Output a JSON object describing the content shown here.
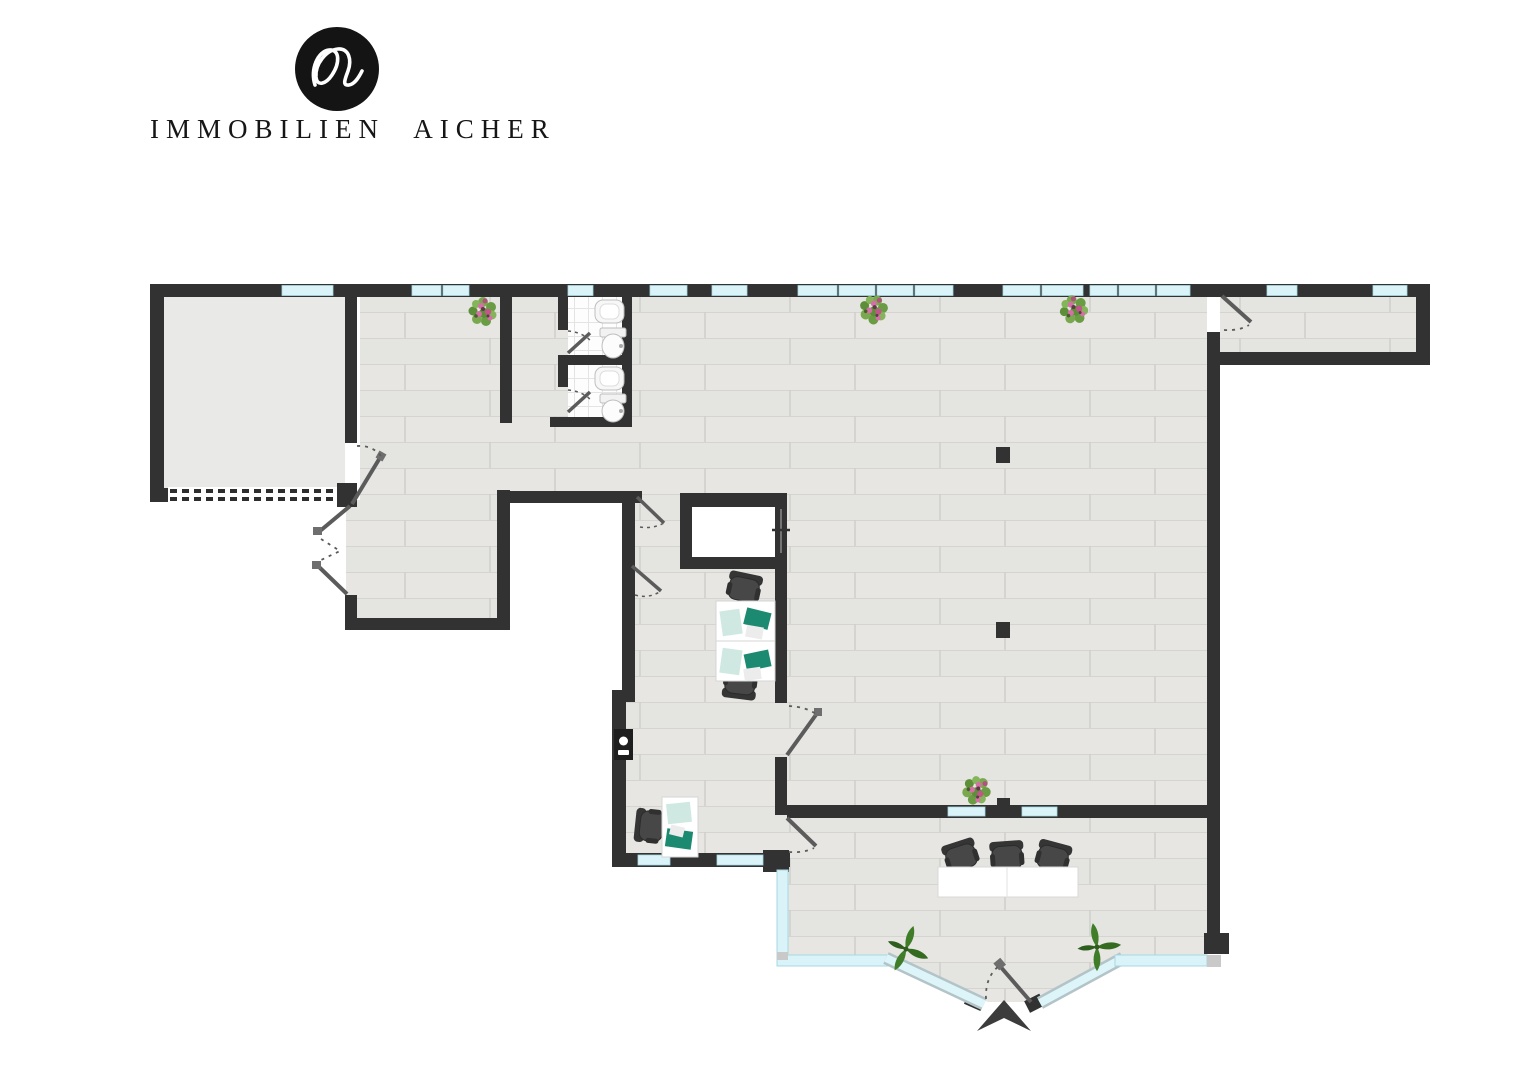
{
  "brand": {
    "name": "IMMOBILIEN AICHER",
    "logo_icon": "wave-monogram-icon"
  },
  "floorplan": {
    "type": "architectural-floor-plan",
    "colors": {
      "wall": "#323232",
      "wood_floor": "#e7e6e3",
      "garage_floor": "#e9e9e8",
      "tile_floor": "#fdfdfd",
      "window_glass": "#d9f3f8",
      "desk_surface": "#ffffff",
      "laptop_teal": "#1c8a70",
      "chair_dark": "#454545",
      "plant_green": "#3f7d28",
      "flower_pink": "#d470a5"
    },
    "icons": [
      "toilet-icon",
      "sink-icon",
      "office-chair-icon",
      "desk-icon",
      "laptop-icon",
      "flower-plant-icon",
      "leaf-plant-icon",
      "wall-intercom-icon",
      "entrance-arrow-icon",
      "door-swing-icon",
      "window-strip",
      "garage-door-dashes",
      "pillar"
    ]
  }
}
